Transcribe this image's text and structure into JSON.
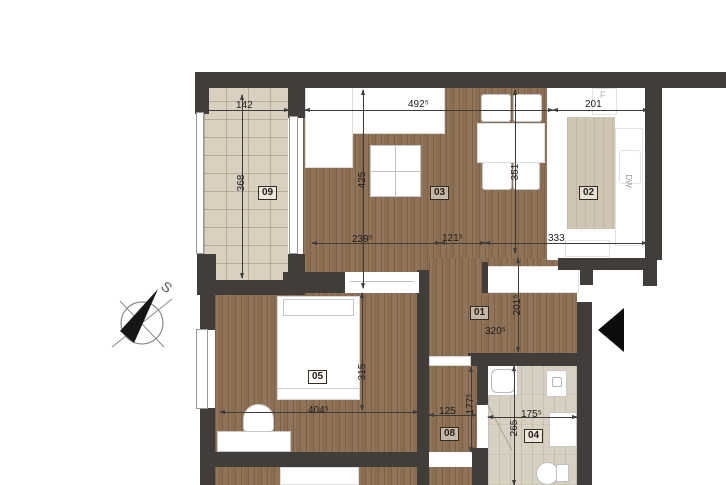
{
  "plan_title": "apartment-floor-plan",
  "compass": {
    "label": "S"
  },
  "rooms": {
    "r01": {
      "number": "01"
    },
    "r02": {
      "number": "02"
    },
    "r03": {
      "number": "03"
    },
    "r04": {
      "number": "04"
    },
    "r05": {
      "number": "05"
    },
    "r08": {
      "number": "08"
    },
    "r09": {
      "number": "09"
    }
  },
  "dimensions": {
    "balcony_width": "142",
    "balcony_depth": "368",
    "living_width": "492⁵",
    "kitchen_width": "201",
    "living_depth": "425",
    "kitchen_depth": "351",
    "living_seg1": "239⁵",
    "living_seg2": "121⁵",
    "kitchen_bottom": "333",
    "hall_width": "320⁵",
    "hall_depth": "201⁵",
    "bedroom_width": "404⁵",
    "bedroom_depth": "315",
    "corridor_width": "125",
    "corridor_depth": "177⁵",
    "bath_width": "175⁵",
    "bath_depth": "265"
  },
  "appliances": {
    "fridge": "F",
    "dishwasher": "DW"
  },
  "colors": {
    "wall": "#403d3a",
    "wood_floor": "#8b6e52",
    "balcony_tile": "#d9d0bf",
    "bath_tile": "#d8d1c1",
    "kitchen_island": "#cfc5b2",
    "entry_arrow": "#0c0c0c"
  }
}
